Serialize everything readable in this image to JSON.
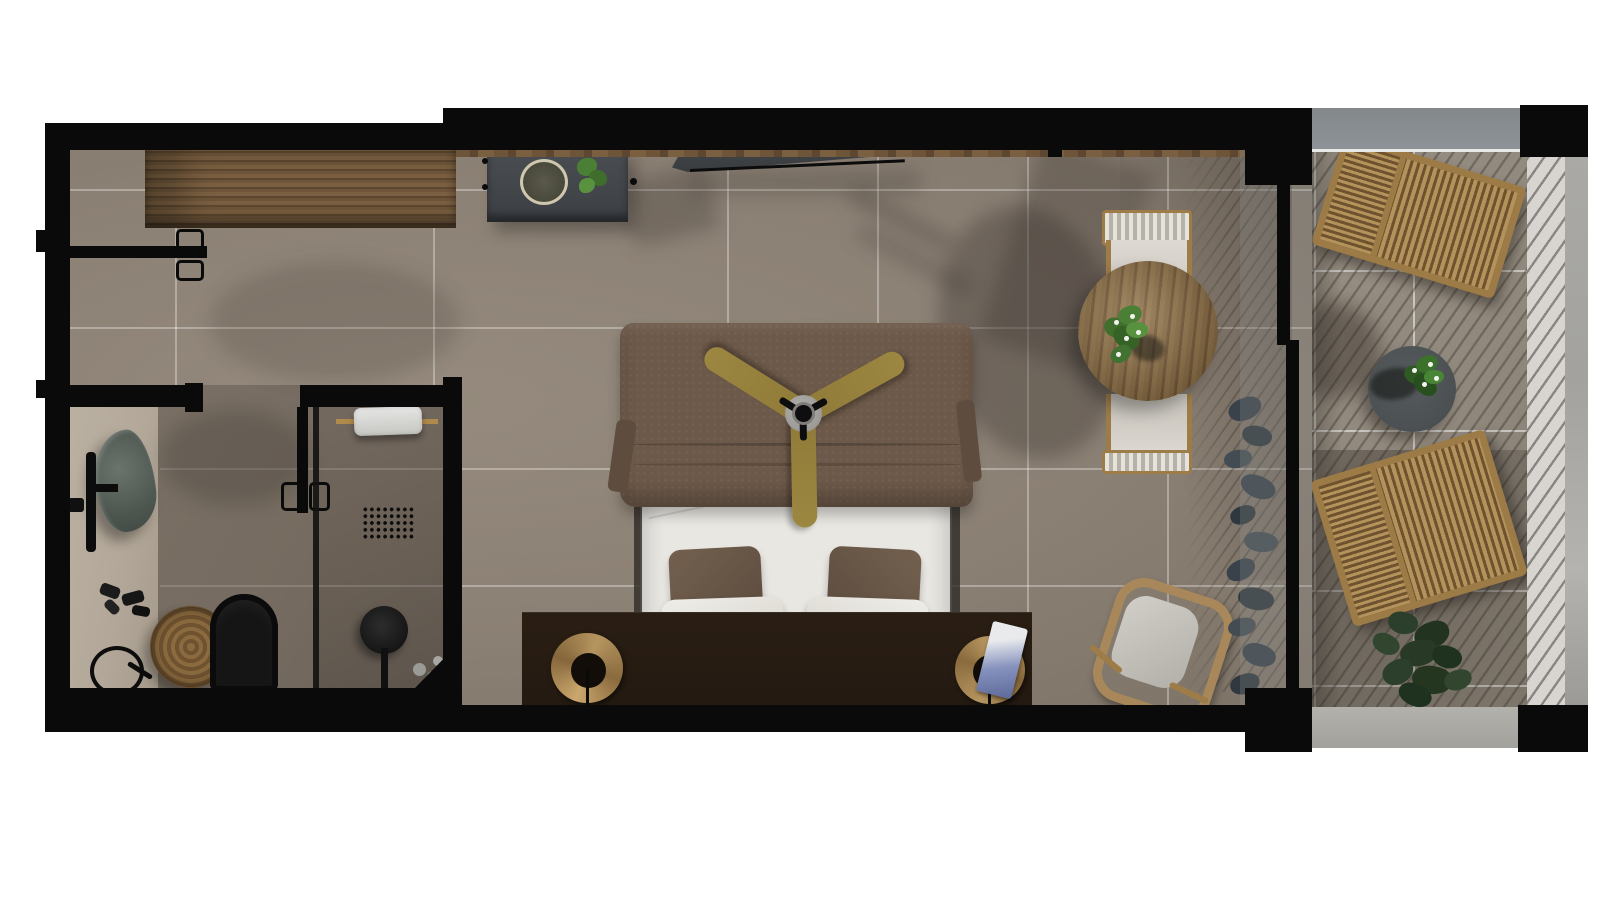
{
  "scene": {
    "kind": "floor-plan-render",
    "view": "top-down 3D",
    "unit": "hotel studio room with bathroom and balcony"
  },
  "colors": {
    "wall": "#0a0a0a",
    "floor": "#8b8074",
    "bathfloor": "#756b60",
    "showerfloor": "#695f55",
    "vanity": "#b2a798",
    "balcfloor": "#90887c",
    "curb": "#b3b1ac",
    "railwhite": "#d8d5d0",
    "railedge": "#a3a29e",
    "glassband": "#8e9397",
    "wood": "#6b5237",
    "woodlight": "#a8885a",
    "desk": "#43474b",
    "tv": "#393c3f",
    "blanket": "#6d5949",
    "sheet": "#e9e7e2",
    "pbrown": "#6a5648",
    "pwhite": "#e6e3dd",
    "chevron": "#5f5340",
    "fanblade": "#9c8741",
    "nightstand": "#241a11",
    "lampwood": "#b5955f",
    "sink": "#57615a",
    "green": "#4a7a33",
    "darkplant": "#39424a",
    "tabledark": "#4b5052"
  },
  "rooms": {
    "entry": {
      "label": "Entry",
      "items": [
        "entry-door",
        "wardrobe-counter"
      ]
    },
    "bathroom": {
      "label": "Bathroom",
      "items": [
        "vanity-counter",
        "stone-sink",
        "faucet",
        "toiletries",
        "magnifying-mirror",
        "laundry-basket",
        "toilet",
        "bathroom-door",
        "shower-screen",
        "towel-rail",
        "towel",
        "floor-drain",
        "shower-head",
        "shampoo-bottles"
      ]
    },
    "bedroom": {
      "label": "Bedroom",
      "items": [
        "console-desk",
        "desk-tray",
        "desk-plant",
        "wall-tv",
        "double-bed",
        "blanket",
        "pillows",
        "ceiling-fan",
        "headboard-console",
        "bedside-lamp-left",
        "bedside-lamp-right",
        "magazine",
        "wicker-stool",
        "snake-plant"
      ]
    },
    "sitting": {
      "label": "Sitting corner",
      "items": [
        "armchair-top",
        "armchair-bottom",
        "round-wood-table",
        "table-plant"
      ]
    },
    "balcony": {
      "label": "Balcony",
      "items": [
        "sliding-glass-door",
        "sun-lounger-top",
        "sun-lounger-bottom",
        "coffee-table",
        "balcony-plant",
        "shrub",
        "glass-railing"
      ]
    }
  }
}
